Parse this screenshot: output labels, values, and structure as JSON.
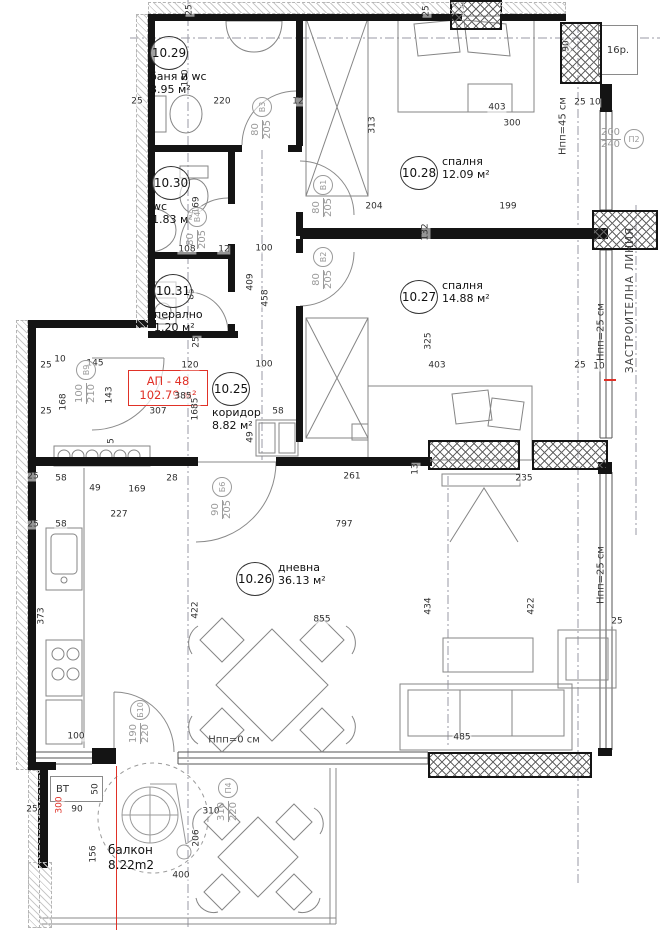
{
  "apartment": {
    "code": "АП - 48",
    "area": "102.79 м²"
  },
  "rooms": [
    {
      "num": "10.29",
      "name": "баня и wc",
      "area": "3.95 м²",
      "x": 150,
      "y": 36,
      "layout": "below"
    },
    {
      "num": "10.30",
      "name": "wc",
      "area": "1.83 м²",
      "x": 152,
      "y": 166,
      "layout": "below"
    },
    {
      "num": "10.31",
      "name": "перално",
      "area": "1.20 м²",
      "x": 154,
      "y": 274,
      "layout": "below"
    },
    {
      "num": "10.25",
      "name": "коридор",
      "area": "8.82 м²",
      "x": 212,
      "y": 372,
      "layout": "below"
    },
    {
      "num": "10.28",
      "name": "спалня",
      "area": "12.09 м²",
      "x": 400,
      "y": 156,
      "layout": "right"
    },
    {
      "num": "10.27",
      "name": "спалня",
      "area": "14.88 м²",
      "x": 400,
      "y": 280,
      "layout": "right"
    },
    {
      "num": "10.26",
      "name": "дневна",
      "area": "36.13 м²",
      "x": 236,
      "y": 562,
      "layout": "right"
    }
  ],
  "balcony": {
    "name": "балкон",
    "area": "8.22m2"
  },
  "corner_label": "16р.",
  "vt_label": "ВТ",
  "door_labels": [
    {
      "id": "В3",
      "size": "80/205",
      "x": 262,
      "y": 118,
      "vertical": true
    },
    {
      "id": "В1",
      "size": "80/205",
      "x": 323,
      "y": 196,
      "vertical": true
    },
    {
      "id": "В2",
      "size": "80/205",
      "x": 323,
      "y": 268,
      "vertical": true
    },
    {
      "id": "В4",
      "size": "80/205",
      "x": 197,
      "y": 228,
      "vertical": true
    },
    {
      "id": "В9",
      "size": "100/210",
      "x": 86,
      "y": 382,
      "vertical": true
    },
    {
      "id": "Б6",
      "size": "90/205",
      "x": 222,
      "y": 498,
      "vertical": true
    },
    {
      "id": "Б10",
      "size": "190/220",
      "x": 140,
      "y": 722,
      "vertical": true
    },
    {
      "id": "П4",
      "size": "310/220",
      "x": 228,
      "y": 800,
      "vertical": true
    },
    {
      "id": "П2",
      "size": "200/240",
      "x": 622,
      "y": 139,
      "vertical": false
    }
  ],
  "annotations": [
    {
      "t": "Hпп=45 см",
      "x": 563,
      "y": 126,
      "v": 1
    },
    {
      "t": "Hпп=25 см",
      "x": 601,
      "y": 332,
      "v": 1
    },
    {
      "t": "Hпп=25 см",
      "x": 601,
      "y": 575,
      "v": 1
    },
    {
      "t": "Hпп=0 см",
      "x": 234,
      "y": 740,
      "v": 0
    },
    {
      "t": "ЗАСТРОИТЕЛНА ЛИНИЯ",
      "x": 630,
      "y": 300,
      "v": 1,
      "cls": "zline"
    }
  ],
  "dims": [
    {
      "t": "25",
      "x": 190,
      "y": 10,
      "v": 1
    },
    {
      "t": "25",
      "x": 427,
      "y": 11,
      "v": 1
    },
    {
      "t": "25",
      "x": 137,
      "y": 102
    },
    {
      "t": "220",
      "x": 222,
      "y": 102
    },
    {
      "t": "12",
      "x": 298,
      "y": 102
    },
    {
      "t": "180",
      "x": 186,
      "y": 78,
      "v": 1
    },
    {
      "t": "90",
      "x": 567,
      "y": 46,
      "v": 1
    },
    {
      "t": "403",
      "x": 497,
      "y": 108
    },
    {
      "t": "300",
      "x": 512,
      "y": 124
    },
    {
      "t": "25",
      "x": 580,
      "y": 103
    },
    {
      "t": "10",
      "x": 595,
      "y": 103
    },
    {
      "t": "313",
      "x": 373,
      "y": 125,
      "v": 1
    },
    {
      "t": "132",
      "x": 426,
      "y": 232,
      "v": 1
    },
    {
      "t": "199",
      "x": 508,
      "y": 207
    },
    {
      "t": "204",
      "x": 374,
      "y": 207
    },
    {
      "t": "169",
      "x": 197,
      "y": 205,
      "v": 1
    },
    {
      "t": "108",
      "x": 187,
      "y": 250
    },
    {
      "t": "12",
      "x": 224,
      "y": 250
    },
    {
      "t": "100",
      "x": 264,
      "y": 249
    },
    {
      "t": "409",
      "x": 251,
      "y": 282,
      "v": 1
    },
    {
      "t": "458",
      "x": 266,
      "y": 298,
      "v": 1
    },
    {
      "t": "85",
      "x": 192,
      "y": 294,
      "v": 1
    },
    {
      "t": "25",
      "x": 197,
      "y": 342,
      "v": 1
    },
    {
      "t": "325",
      "x": 429,
      "y": 341,
      "v": 1
    },
    {
      "t": "120",
      "x": 190,
      "y": 366
    },
    {
      "t": "100",
      "x": 264,
      "y": 365
    },
    {
      "t": "145",
      "x": 95,
      "y": 364
    },
    {
      "t": "10",
      "x": 60,
      "y": 360
    },
    {
      "t": "25",
      "x": 46,
      "y": 366
    },
    {
      "t": "143",
      "x": 110,
      "y": 395,
      "v": 1
    },
    {
      "t": "168",
      "x": 64,
      "y": 402,
      "v": 1
    },
    {
      "t": "25",
      "x": 46,
      "y": 412
    },
    {
      "t": "307",
      "x": 158,
      "y": 412
    },
    {
      "t": "385",
      "x": 183,
      "y": 397
    },
    {
      "t": "1685",
      "x": 196,
      "y": 409,
      "v": 1
    },
    {
      "t": "58",
      "x": 278,
      "y": 412
    },
    {
      "t": "403",
      "x": 437,
      "y": 366
    },
    {
      "t": "25",
      "x": 580,
      "y": 366
    },
    {
      "t": "10",
      "x": 599,
      "y": 367
    },
    {
      "t": "49",
      "x": 251,
      "y": 437,
      "v": 1
    },
    {
      "t": "5",
      "x": 112,
      "y": 441,
      "v": 1
    },
    {
      "t": "13",
      "x": 416,
      "y": 469,
      "v": 1
    },
    {
      "t": "261",
      "x": 352,
      "y": 477
    },
    {
      "t": "235",
      "x": 524,
      "y": 479
    },
    {
      "t": "797",
      "x": 344,
      "y": 525
    },
    {
      "t": "25",
      "x": 33,
      "y": 477
    },
    {
      "t": "58",
      "x": 61,
      "y": 479
    },
    {
      "t": "28",
      "x": 172,
      "y": 479
    },
    {
      "t": "169",
      "x": 137,
      "y": 490
    },
    {
      "t": "49",
      "x": 95,
      "y": 489
    },
    {
      "t": "227",
      "x": 119,
      "y": 515
    },
    {
      "t": "25",
      "x": 33,
      "y": 525
    },
    {
      "t": "58",
      "x": 61,
      "y": 525
    },
    {
      "t": "373",
      "x": 42,
      "y": 616,
      "v": 1
    },
    {
      "t": "422",
      "x": 196,
      "y": 610,
      "v": 1
    },
    {
      "t": "855",
      "x": 322,
      "y": 620
    },
    {
      "t": "434",
      "x": 429,
      "y": 606,
      "v": 1
    },
    {
      "t": "422",
      "x": 532,
      "y": 606,
      "v": 1
    },
    {
      "t": "25",
      "x": 617,
      "y": 622
    },
    {
      "t": "485",
      "x": 462,
      "y": 738
    },
    {
      "t": "100",
      "x": 76,
      "y": 737
    },
    {
      "t": "50",
      "x": 96,
      "y": 789,
      "v": 1
    },
    {
      "t": "90",
      "x": 77,
      "y": 810
    },
    {
      "t": "25",
      "x": 32,
      "y": 810
    },
    {
      "t": "310",
      "x": 211,
      "y": 812
    },
    {
      "t": "206",
      "x": 197,
      "y": 838,
      "v": 1
    },
    {
      "t": "156",
      "x": 94,
      "y": 854,
      "v": 1
    },
    {
      "t": "400",
      "x": 181,
      "y": 876
    },
    {
      "t": "300",
      "x": 60,
      "y": 805,
      "v": 1,
      "r": 1
    }
  ],
  "colors": {
    "wall": "#141414",
    "red": "#e03127",
    "dim": "#2e2e2e",
    "thin": "#808080"
  }
}
